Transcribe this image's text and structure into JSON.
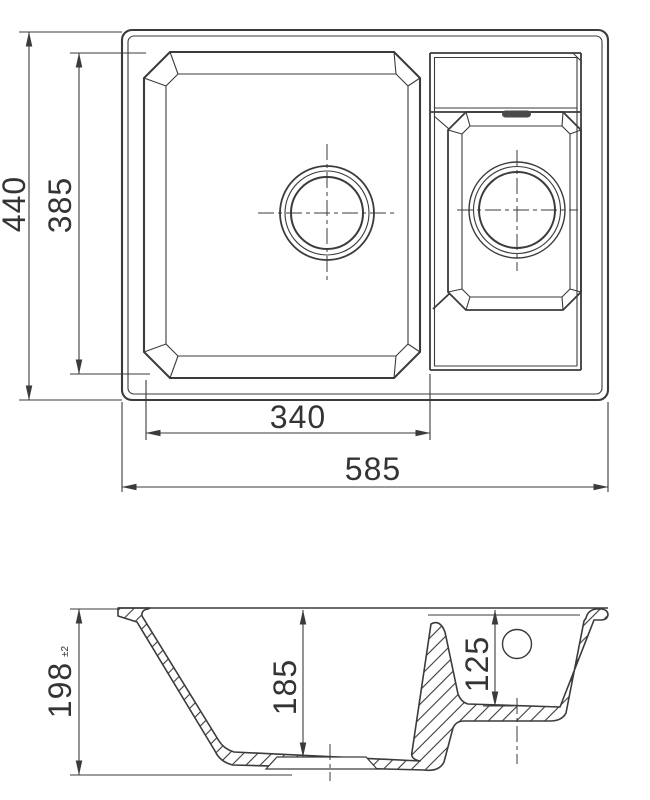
{
  "drawing": {
    "type": "technical dimension drawing",
    "views": {
      "plan": "top view",
      "section": "front section view"
    }
  },
  "dimensions": {
    "overall_width": "585",
    "overall_depth": "440",
    "main_bowl_length": "385",
    "main_bowl_width": "340",
    "overall_height": "198",
    "overall_height_tolerance": "±2",
    "main_bowl_depth": "185",
    "small_bowl_depth": "125"
  },
  "colors": {
    "line": "#3b3b3b",
    "text": "#343434",
    "overflow_slot_fill": "#4a4a4a",
    "background": "#ffffff"
  }
}
